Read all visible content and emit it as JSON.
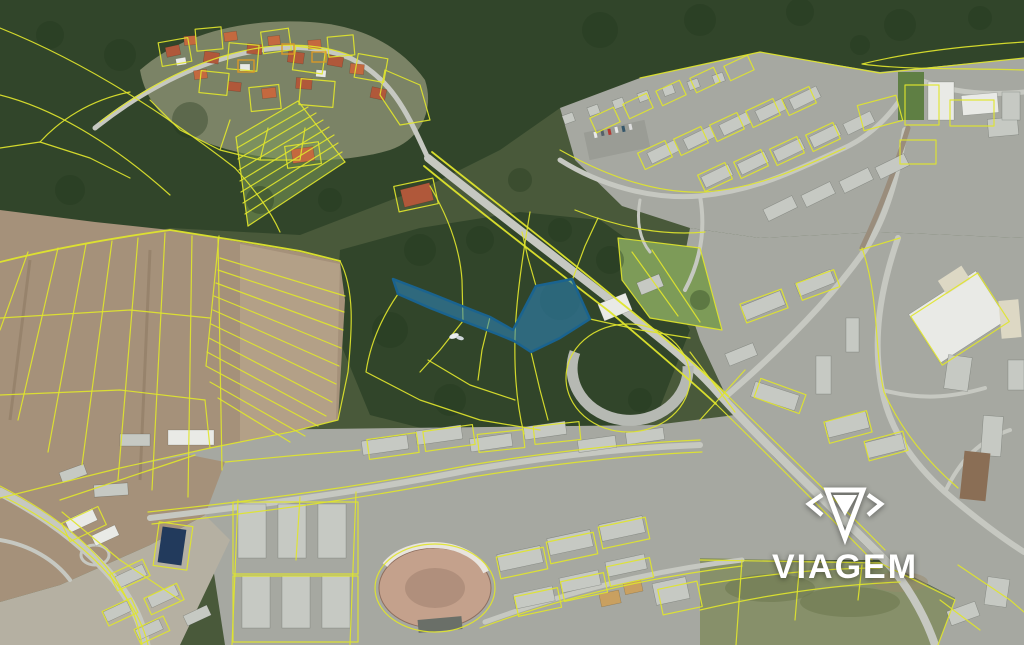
{
  "watermark": {
    "brand": "VIAGEM"
  },
  "highlight_parcel": {
    "description": "blue highlighted cadastral parcel (narrow strip joining larger wooded lot)",
    "points": "393,279 427,292 462,306 490,317 513,330 536,286 572,279 590,319 560,338 531,352 514,341 497,334 463,321 430,308 398,294",
    "fill": "#2e86c1",
    "fill_opacity": "0.55",
    "stroke": "#1a638f",
    "stroke_width": "2.5"
  },
  "palette": {
    "cadastral_line": "#dfe52c",
    "cadastral_accent": "#dd9a25",
    "highlight_fill": "#2e86c1",
    "highlight_stroke": "#1a638f",
    "forest_dark": "#31452a",
    "forest_base": "#49593a",
    "meadow_green": "#7d9b58",
    "field_brown": "#a5917a",
    "field_tan": "#b5a28a",
    "urban_gray": "#a6a8a1",
    "road_gray": "#c6c8c1",
    "building_light": "#c6c9c3",
    "building_white": "#e9eae6",
    "roof_red": "#b0583a",
    "roof_navy": "#223a5c",
    "watermark_white": "#ffffff"
  }
}
